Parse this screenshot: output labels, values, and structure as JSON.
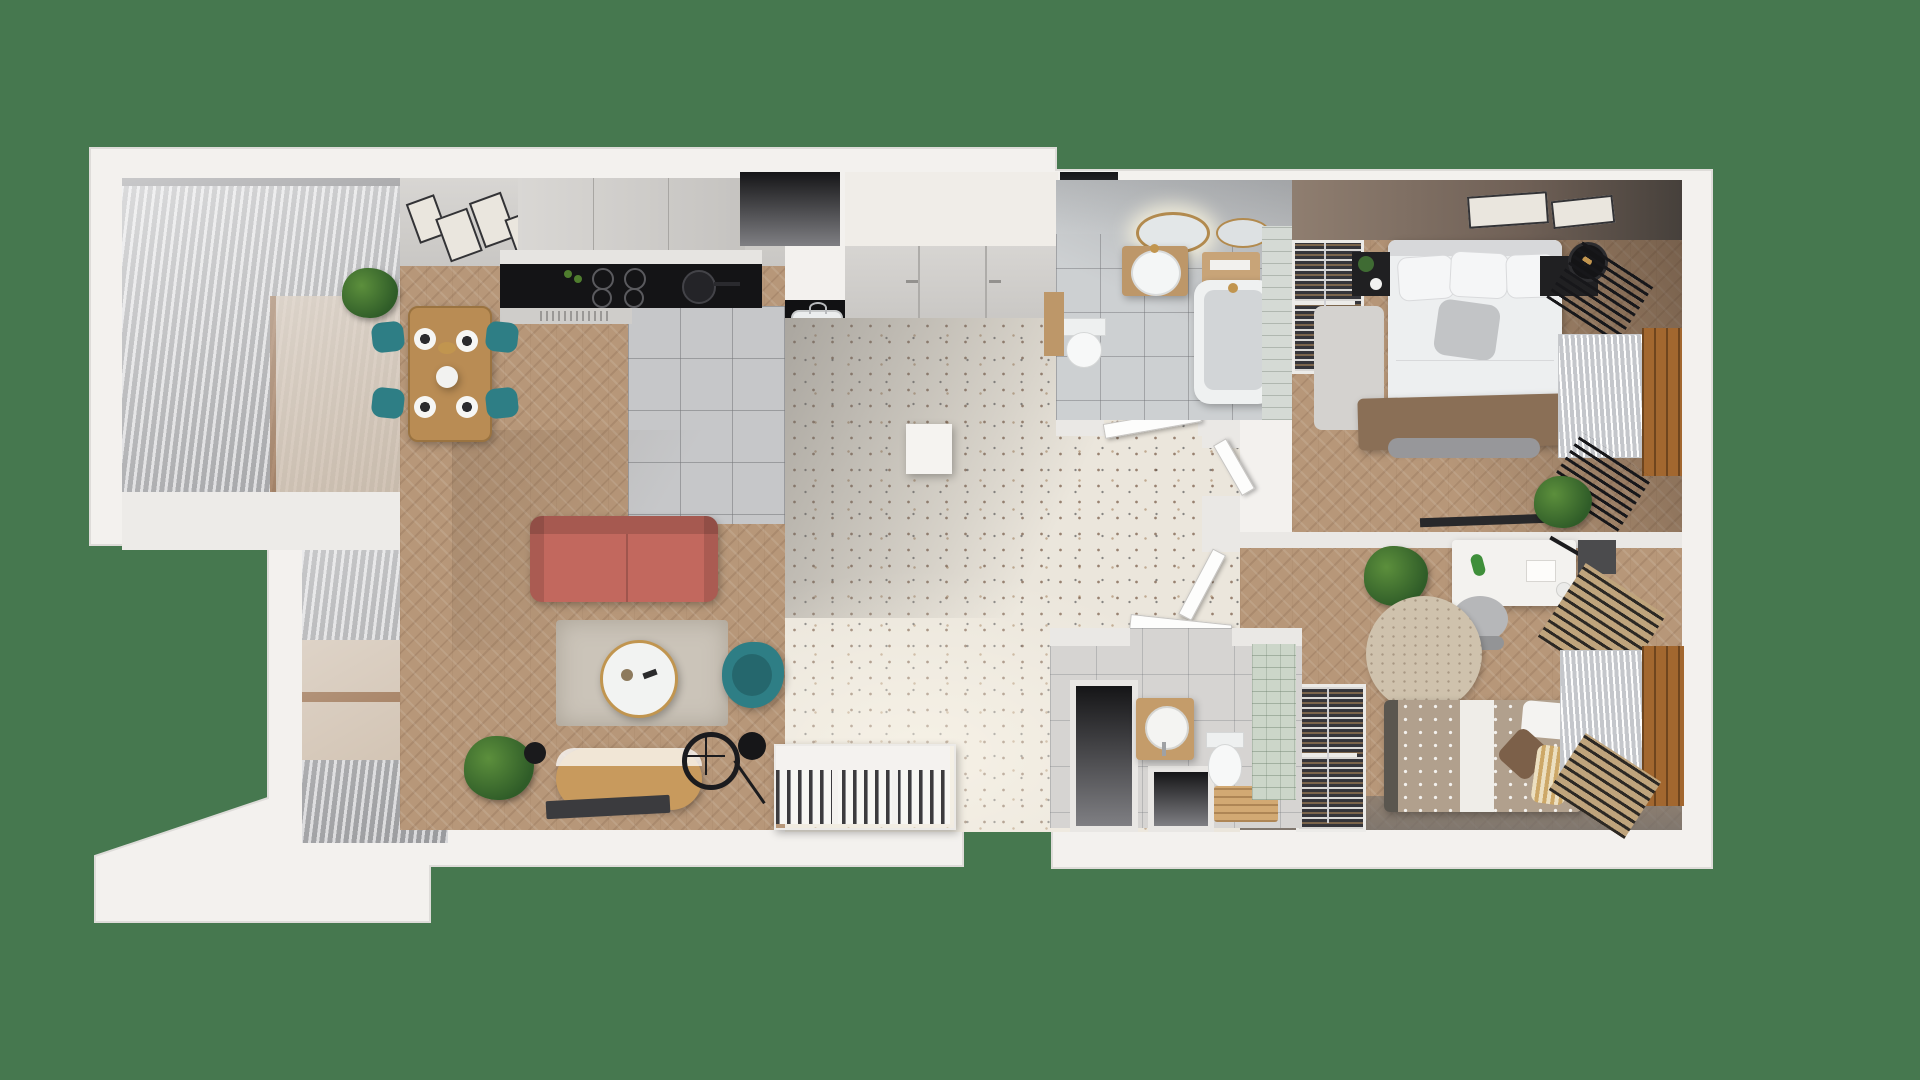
{
  "meta": {
    "title": "Top-down 3D render of a two-bedroom apartment floor plan",
    "view": "top-down photoreal floorplan on a green backdrop",
    "text_on_screen": "none"
  },
  "palette": {
    "bg": "#46784f",
    "wall": "#f3f1ee",
    "wall_face": "#d3d1ce",
    "wood": "#b79779",
    "wood_dark": "#9a7c62",
    "tile": "#c6c7c9",
    "terrazzo": "#ebe6dc",
    "terrazzo_shadow": "#c8c6c3",
    "bath_floor": "#cdd0d2",
    "bath_wall_tile": "#d5dad5",
    "green_wall_tile": "#ccd6c9",
    "sofa_coral": "#c2685e",
    "teal": "#2e7e85",
    "table_wood": "#b98c54",
    "rug": "#cbc4b9",
    "appliance_black": "#141416",
    "blanket_brown": "#8a6f56",
    "kids_duvet": "#b1a08d",
    "radiator_tan": "#bfa47c",
    "window_frame_wood": "#a2672f",
    "bedroom_wall_brown": "#8f7e70",
    "plant_green": "#3f6b33",
    "gold": "#c1954f"
  },
  "rooms": [
    {
      "id": "balcony-upper",
      "name": "Upper balcony with louvered pergola",
      "floor": "stone tile"
    },
    {
      "id": "dining-area",
      "name": "Dining area",
      "floor": "herringbone wood",
      "furniture": [
        "wood dining table",
        "4 teal chairs",
        "4 place settings",
        "centerpiece",
        "wall art frames",
        "potted plant"
      ]
    },
    {
      "id": "kitchen",
      "name": "Kitchen",
      "floor": "gray ceramic tile",
      "furniture": [
        "upper cabinet run",
        "countertop",
        "black induction cooktop with pan",
        "vent grille",
        "black pantry column with sink and bottles",
        "wine rack"
      ]
    },
    {
      "id": "living-room",
      "name": "Living room",
      "floor": "herringbone wood",
      "furniture": [
        "coral sofa",
        "area rug",
        "round coffee table",
        "teal armchair",
        "TV sideboard",
        "flat TV panel",
        "floor lamp",
        "wheel stand",
        "potted palm",
        "record shelf unit"
      ]
    },
    {
      "id": "entry-hall",
      "name": "Entry hall",
      "floor": "terrazzo",
      "furniture": [
        "built-in wardrobe",
        "shoe cabinet",
        "open interior doors"
      ]
    },
    {
      "id": "bathroom",
      "name": "Main bathroom",
      "floor": "gray tile",
      "furniture": [
        "backlit round mirror",
        "second mirror",
        "wood vanity with round basin",
        "wood shelf with towel",
        "bathtub",
        "toilet",
        "tall wood cabinet",
        "tiled wall strip"
      ]
    },
    {
      "id": "master-bedroom",
      "name": "Master bedroom",
      "floor": "herringbone wood",
      "furniture": [
        "double bed with brown blanket",
        "open wardrobe with clothes",
        "folded linen stack",
        "2 black nightstands",
        "table lamp",
        "2 slatted radiators",
        "window with blinds",
        "wall TV strip",
        "2 picture frames",
        "rug",
        "plant"
      ]
    },
    {
      "id": "kids-room",
      "name": "Second bedroom",
      "floor": "herringbone wood",
      "furniture": [
        "single bed with patterned duvet",
        "pillows",
        "white desk",
        "desk chair",
        "round rug",
        "shoe rack",
        "2 tan radiators",
        "window with blinds",
        "potted plant",
        "dark cabinet"
      ]
    },
    {
      "id": "wc",
      "name": "Guest WC",
      "floor": "gray tile",
      "furniture": [
        "round basin on wood stand",
        "toilet",
        "wood bench",
        "green tiled wall",
        "installation voids"
      ]
    },
    {
      "id": "balcony-lower",
      "name": "Lower balcony",
      "floor": "stone tile"
    },
    {
      "id": "terrace",
      "name": "Terrace slab",
      "floor": "concrete"
    }
  ],
  "counts": {
    "open_doors": 4,
    "dark_voids": 4,
    "picture_frames_dining": 4,
    "picture_frames_bedroom": 2
  }
}
